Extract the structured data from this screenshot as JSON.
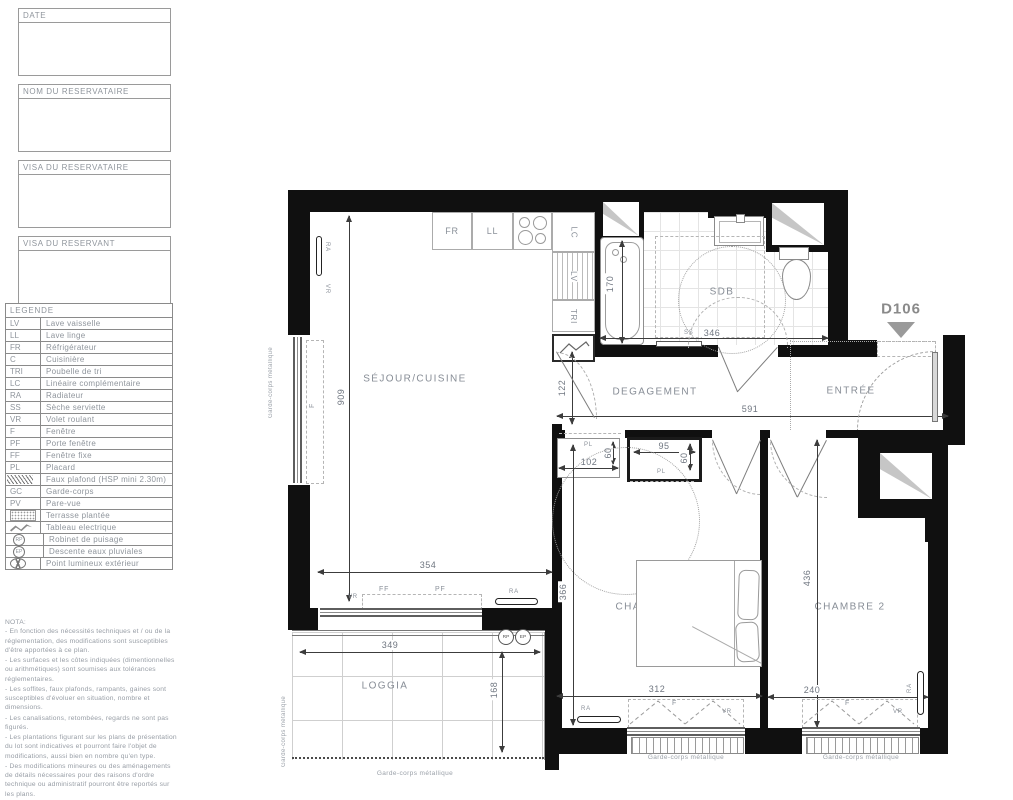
{
  "sidebar": {
    "title_blocks": [
      "DATE",
      "NOM DU RESERVATAIRE",
      "VISA DU RESERVATAIRE",
      "VISA DU RESERVANT"
    ],
    "legend": {
      "title": "LEGENDE",
      "items": [
        {
          "abbr": "LV",
          "label": "Lave vaisselle",
          "icon": "text"
        },
        {
          "abbr": "LL",
          "label": "Lave linge",
          "icon": "text"
        },
        {
          "abbr": "FR",
          "label": "Réfrigérateur",
          "icon": "text"
        },
        {
          "abbr": "C",
          "label": "Cuisinière",
          "icon": "text"
        },
        {
          "abbr": "TRI",
          "label": "Poubelle de tri",
          "icon": "text"
        },
        {
          "abbr": "LC",
          "label": "Linéaire complémentaire",
          "icon": "text"
        },
        {
          "abbr": "RA",
          "label": "Radiateur",
          "icon": "text"
        },
        {
          "abbr": "SS",
          "label": "Sèche serviette",
          "icon": "text"
        },
        {
          "abbr": "VR",
          "label": "Volet roulant",
          "icon": "text"
        },
        {
          "abbr": "F",
          "label": "Fenêtre",
          "icon": "text"
        },
        {
          "abbr": "PF",
          "label": "Porte fenêtre",
          "icon": "text"
        },
        {
          "abbr": "FF",
          "label": "Fenêtre fixe",
          "icon": "text"
        },
        {
          "abbr": "PL",
          "label": "Placard",
          "icon": "text"
        },
        {
          "abbr": "",
          "label": "Faux plafond (HSP mini 2.30m)",
          "icon": "hatch"
        },
        {
          "abbr": "GC",
          "label": "Garde-corps",
          "icon": "text"
        },
        {
          "abbr": "PV",
          "label": "Pare-vue",
          "icon": "text"
        },
        {
          "abbr": "",
          "label": "Terrasse plantée",
          "icon": "dots"
        },
        {
          "abbr": "",
          "label": "Tableau electrique",
          "icon": "zigzag"
        },
        {
          "abbr": "RP",
          "label": "Robinet de puisage",
          "icon": "circle"
        },
        {
          "abbr": "EP",
          "label": "Descente eaux pluviales",
          "icon": "circle"
        },
        {
          "abbr": "",
          "label": "Point lumineux extérieur",
          "icon": "lamp"
        }
      ]
    },
    "nota": {
      "title": "NOTA:",
      "lines": [
        "- En fonction des nécessités techniques et / ou de la réglementation, des modifications sont susceptibles d'être apportées à ce plan.",
        "- Les surfaces et les côtes indiquées (dimentionnelles ou arithmétiques) sont soumises aux tolérances réglementaires.",
        "- Les soffites, faux plafonds, rampants, gaines sont susceptibles d'évoluer en situation, nombre et dimensions.",
        "- Les canalisations, retombées, regards ne sont pas figurés.",
        "- Les plantations figurant sur les plans de présentation du lot sont indicatives et pourront faire l'objet de modifications, aussi bien en nombre qu'en type.",
        "- Des modifications mineures ou des aménagements de détails nécessaires pour des raisons d'ordre technique ou administratif pourront être reportés sur les plans.",
        "- La surface habitable comprend les placards.",
        "- Les emplacements machines sont en pointillés, mais les appareils ne sont pas fournis."
      ]
    }
  },
  "plan": {
    "unit_id": "D106",
    "rooms": {
      "sejour": "SÉJOUR/CUISINE",
      "degagement": "DEGAGEMENT",
      "entree": "ENTRÉE",
      "sdb": "SDB",
      "chambre1": "CHAMBRE 1",
      "chambre2": "CHAMBRE 2",
      "loggia": "LOGGIA"
    },
    "appliances": {
      "fr": "FR",
      "ll": "LL",
      "lc": "LC",
      "lv": "LV",
      "tri": "TRI"
    },
    "tags": {
      "ra": "RA",
      "vr": "VR",
      "f": "F",
      "pf": "PF",
      "ff": "FF",
      "pl": "PL",
      "ss": "SS",
      "rp": "RP",
      "ep": "EP"
    },
    "dims": {
      "d909": "909",
      "d354": "354",
      "d349": "349",
      "d168": "168",
      "d346": "346",
      "d170": "170",
      "d122": "122",
      "d591": "591",
      "d102": "102",
      "d95": "95",
      "d60": "60",
      "d366": "366",
      "d312": "312",
      "d436": "436",
      "d240": "240"
    },
    "notes": {
      "garde_corps": "Garde-corps métallique"
    }
  }
}
